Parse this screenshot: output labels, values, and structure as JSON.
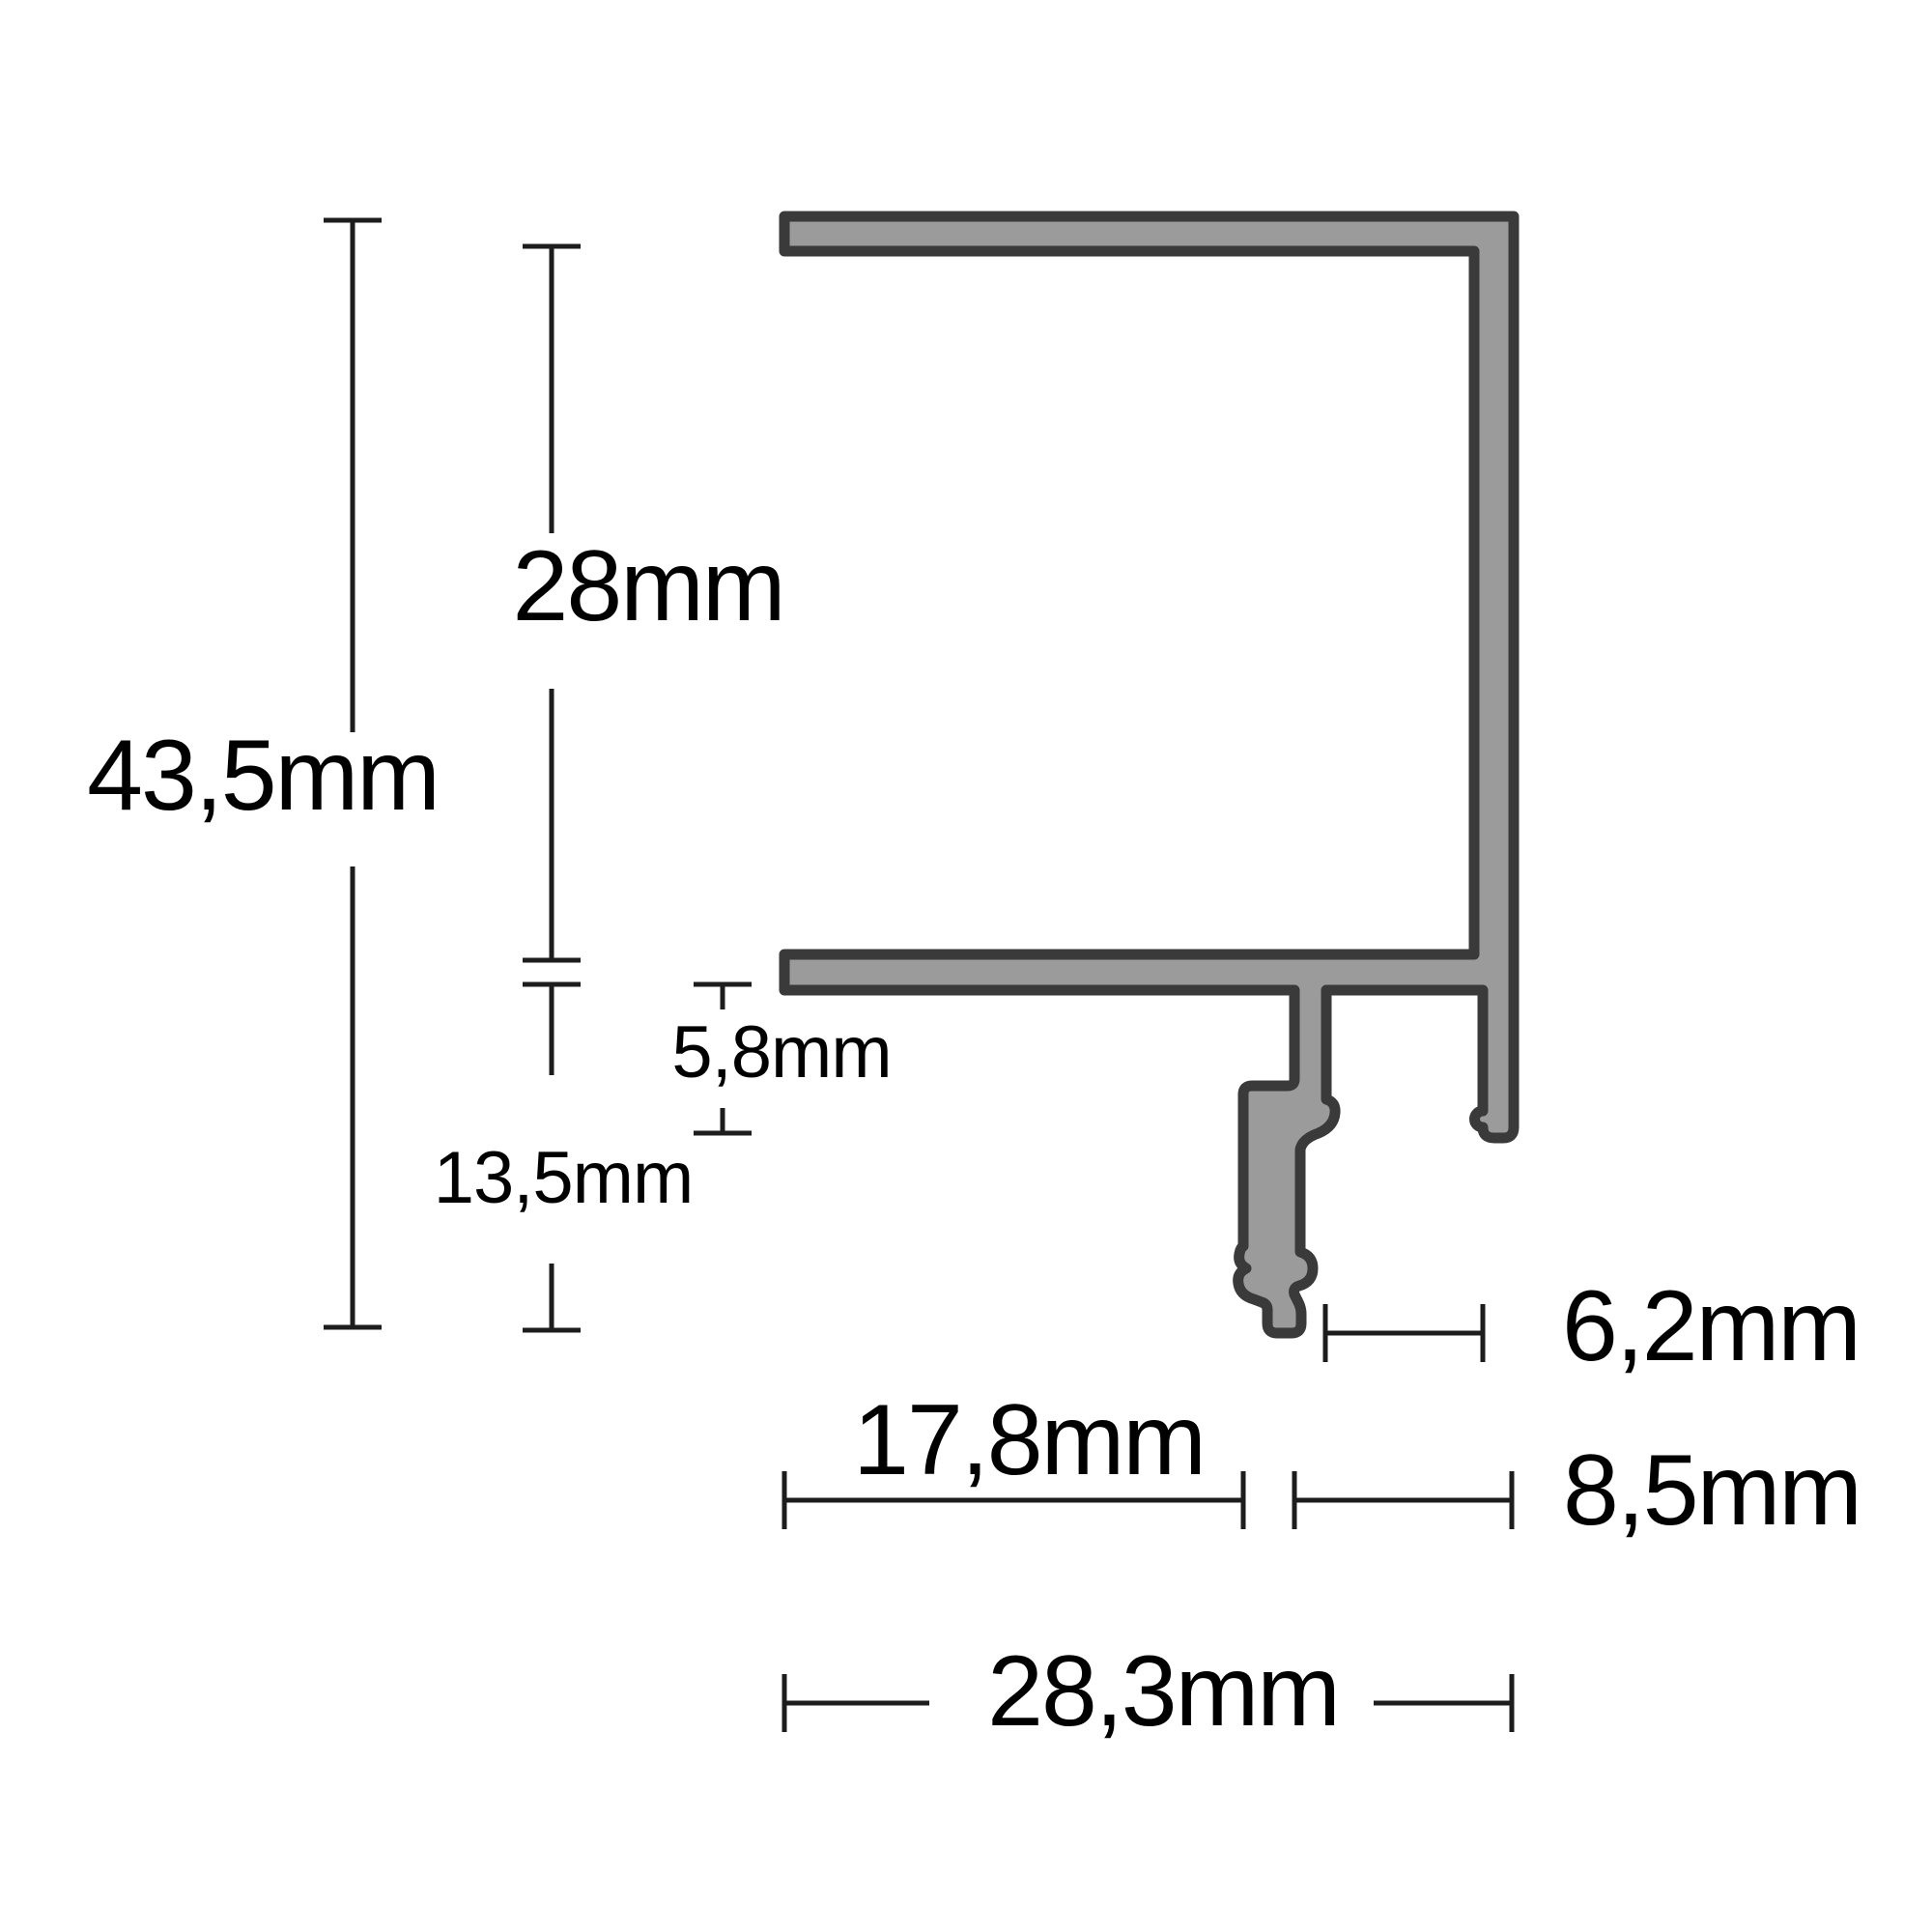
{
  "drawing": {
    "type": "profile-cross-section-dimension-diagram",
    "unit": "mm",
    "colors": {
      "background": "#ffffff",
      "profile_fill": "#9b9b9b",
      "profile_outline": "#3a3a3a",
      "dimension_line": "#1d1d1d",
      "label_text": "#000000"
    },
    "dimensions": {
      "overall_height": "43,5mm",
      "upper_height": "28mm",
      "lip_depth": "5,8mm",
      "hook_height": "13,5mm",
      "slot_width": "6,2mm",
      "inner_width": "17,8mm",
      "side_width": "8,5mm",
      "overall_width": "28,3mm"
    }
  }
}
